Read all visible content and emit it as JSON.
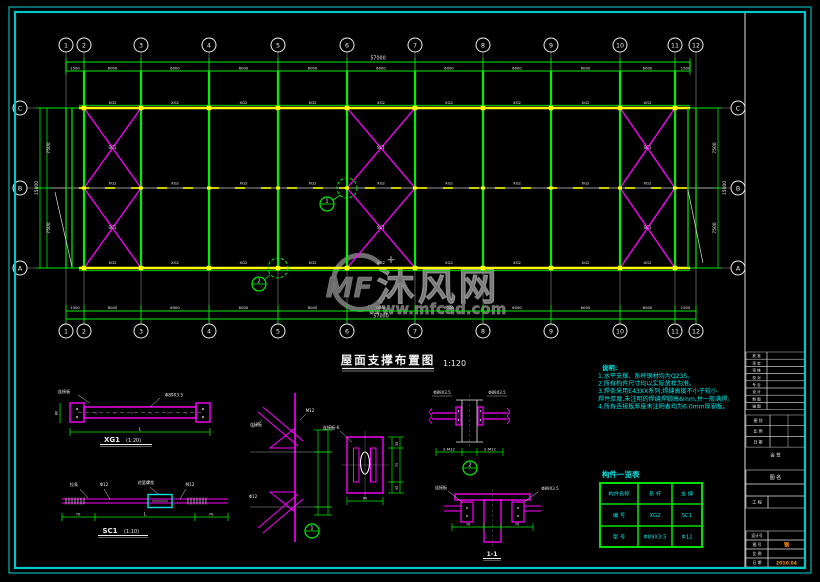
{
  "colors": {
    "line_green": "#00f000",
    "chord_yellow": "#ffff00",
    "brace_magenta": "#ff00ff",
    "frame_cyan": "#00c8c8",
    "note_cyan": "#00e8e8",
    "table_green": "#00e000",
    "accent_orange": "#ff9500",
    "watermark_gray": "#6e6e6e",
    "white": "#f0f0f0",
    "leader_gray": "#8c8c8c"
  },
  "watermark": {
    "logo": "MF",
    "plus": "+",
    "name": "沐风网",
    "url": "www.mfcad.com"
  },
  "plan": {
    "title": "屋面支撑布置图",
    "scale": "1:120",
    "axis_numbers": [
      "1",
      "2",
      "3",
      "4",
      "5",
      "6",
      "7",
      "8",
      "9",
      "10",
      "11",
      "12"
    ],
    "axis_letters": [
      "C",
      "B",
      "A"
    ],
    "dims": {
      "top_bays": [
        "1500",
        "6000",
        "6000",
        "6000",
        "6000",
        "6000",
        "6000",
        "6000",
        "6000",
        "6000",
        "1500"
      ],
      "top_total": "57000",
      "bottom_bays": [
        "1500",
        "6000",
        "6000",
        "6000",
        "6000",
        "6000",
        "6000",
        "6000",
        "6000",
        "6000",
        "1500"
      ],
      "bottom_total": "57000",
      "left_bays": [
        "7500",
        "7500"
      ],
      "left_total": "15000",
      "right_bays": [
        "7500",
        "7500"
      ],
      "right_total": "15000"
    },
    "member_tags": {
      "tie": "XG2",
      "brace": "SC1"
    },
    "callouts": [
      {
        "num": "1"
      },
      {
        "num": "2"
      }
    ]
  },
  "notes": {
    "title": "说明:",
    "lines": [
      "1.水平支撑、系杆钢材均为Q235。",
      "2.所有构件尺寸均以实际放样为准。",
      "3.焊条采用E43XX系列,焊缝高度不小于较小",
      "  焊件厚度,未注明的焊缝焊脚高6mm,并一般满焊。",
      "4.所有连接板厚度未注明者均为6.0mm厚钢板。"
    ]
  },
  "component_table": {
    "title": "构件一览表",
    "rows": [
      [
        "构件名称",
        "系 杆",
        "支 撑"
      ],
      [
        "编  号",
        "XG2",
        "SC1"
      ],
      [
        "型  号",
        "Φ89X3.5",
        "Φ12"
      ]
    ]
  },
  "details": {
    "xg1": {
      "name": "XG1",
      "scale": "(1:20)",
      "dim": "L",
      "height_dim": "80",
      "annotations": [
        "连接板",
        "Φ89X3.5"
      ]
    },
    "sc1": {
      "name": "SC1",
      "scale": "(1:10)",
      "dim": "L",
      "end_dims": [
        "70",
        "70"
      ],
      "annotations": [
        "拉条",
        "Φ12",
        "花篮螺栓",
        "M12"
      ]
    },
    "node": {
      "num": "1",
      "annotations": [
        "连接板",
        "M12",
        "Φ12"
      ]
    },
    "plate": {
      "annotation": "连接板-6",
      "dims_right": [
        "35",
        "70",
        "35"
      ],
      "dim_bottom": "60"
    },
    "tie": {
      "num": "2",
      "annotations": [
        "Φ89X3.5",
        "Φ89X3.5"
      ],
      "bolt_labels": [
        "2-M12",
        "2-M12"
      ]
    },
    "tsec": {
      "name": "1-1",
      "annotations": [
        "连接板",
        "Φ89X3.5"
      ],
      "dims": [
        "70",
        "70"
      ]
    }
  },
  "title_block": {
    "sign_rows": [
      "批 准",
      "审 定",
      "审 核",
      "校 对",
      "专 业",
      "设 计",
      "制 图",
      "描 图"
    ],
    "mini_rows": [
      "图 别",
      "比 例",
      "日 期"
    ],
    "countersign": "会 签",
    "drawing_name_label": "图 名",
    "project_label": "工 程",
    "bottom_rows": [
      {
        "label": "设计号",
        "value": ""
      },
      {
        "label": "图 号",
        "value": "钢"
      },
      {
        "label": "比 例",
        "value": ""
      },
      {
        "label": "日 期",
        "value": "2010.04"
      }
    ]
  }
}
